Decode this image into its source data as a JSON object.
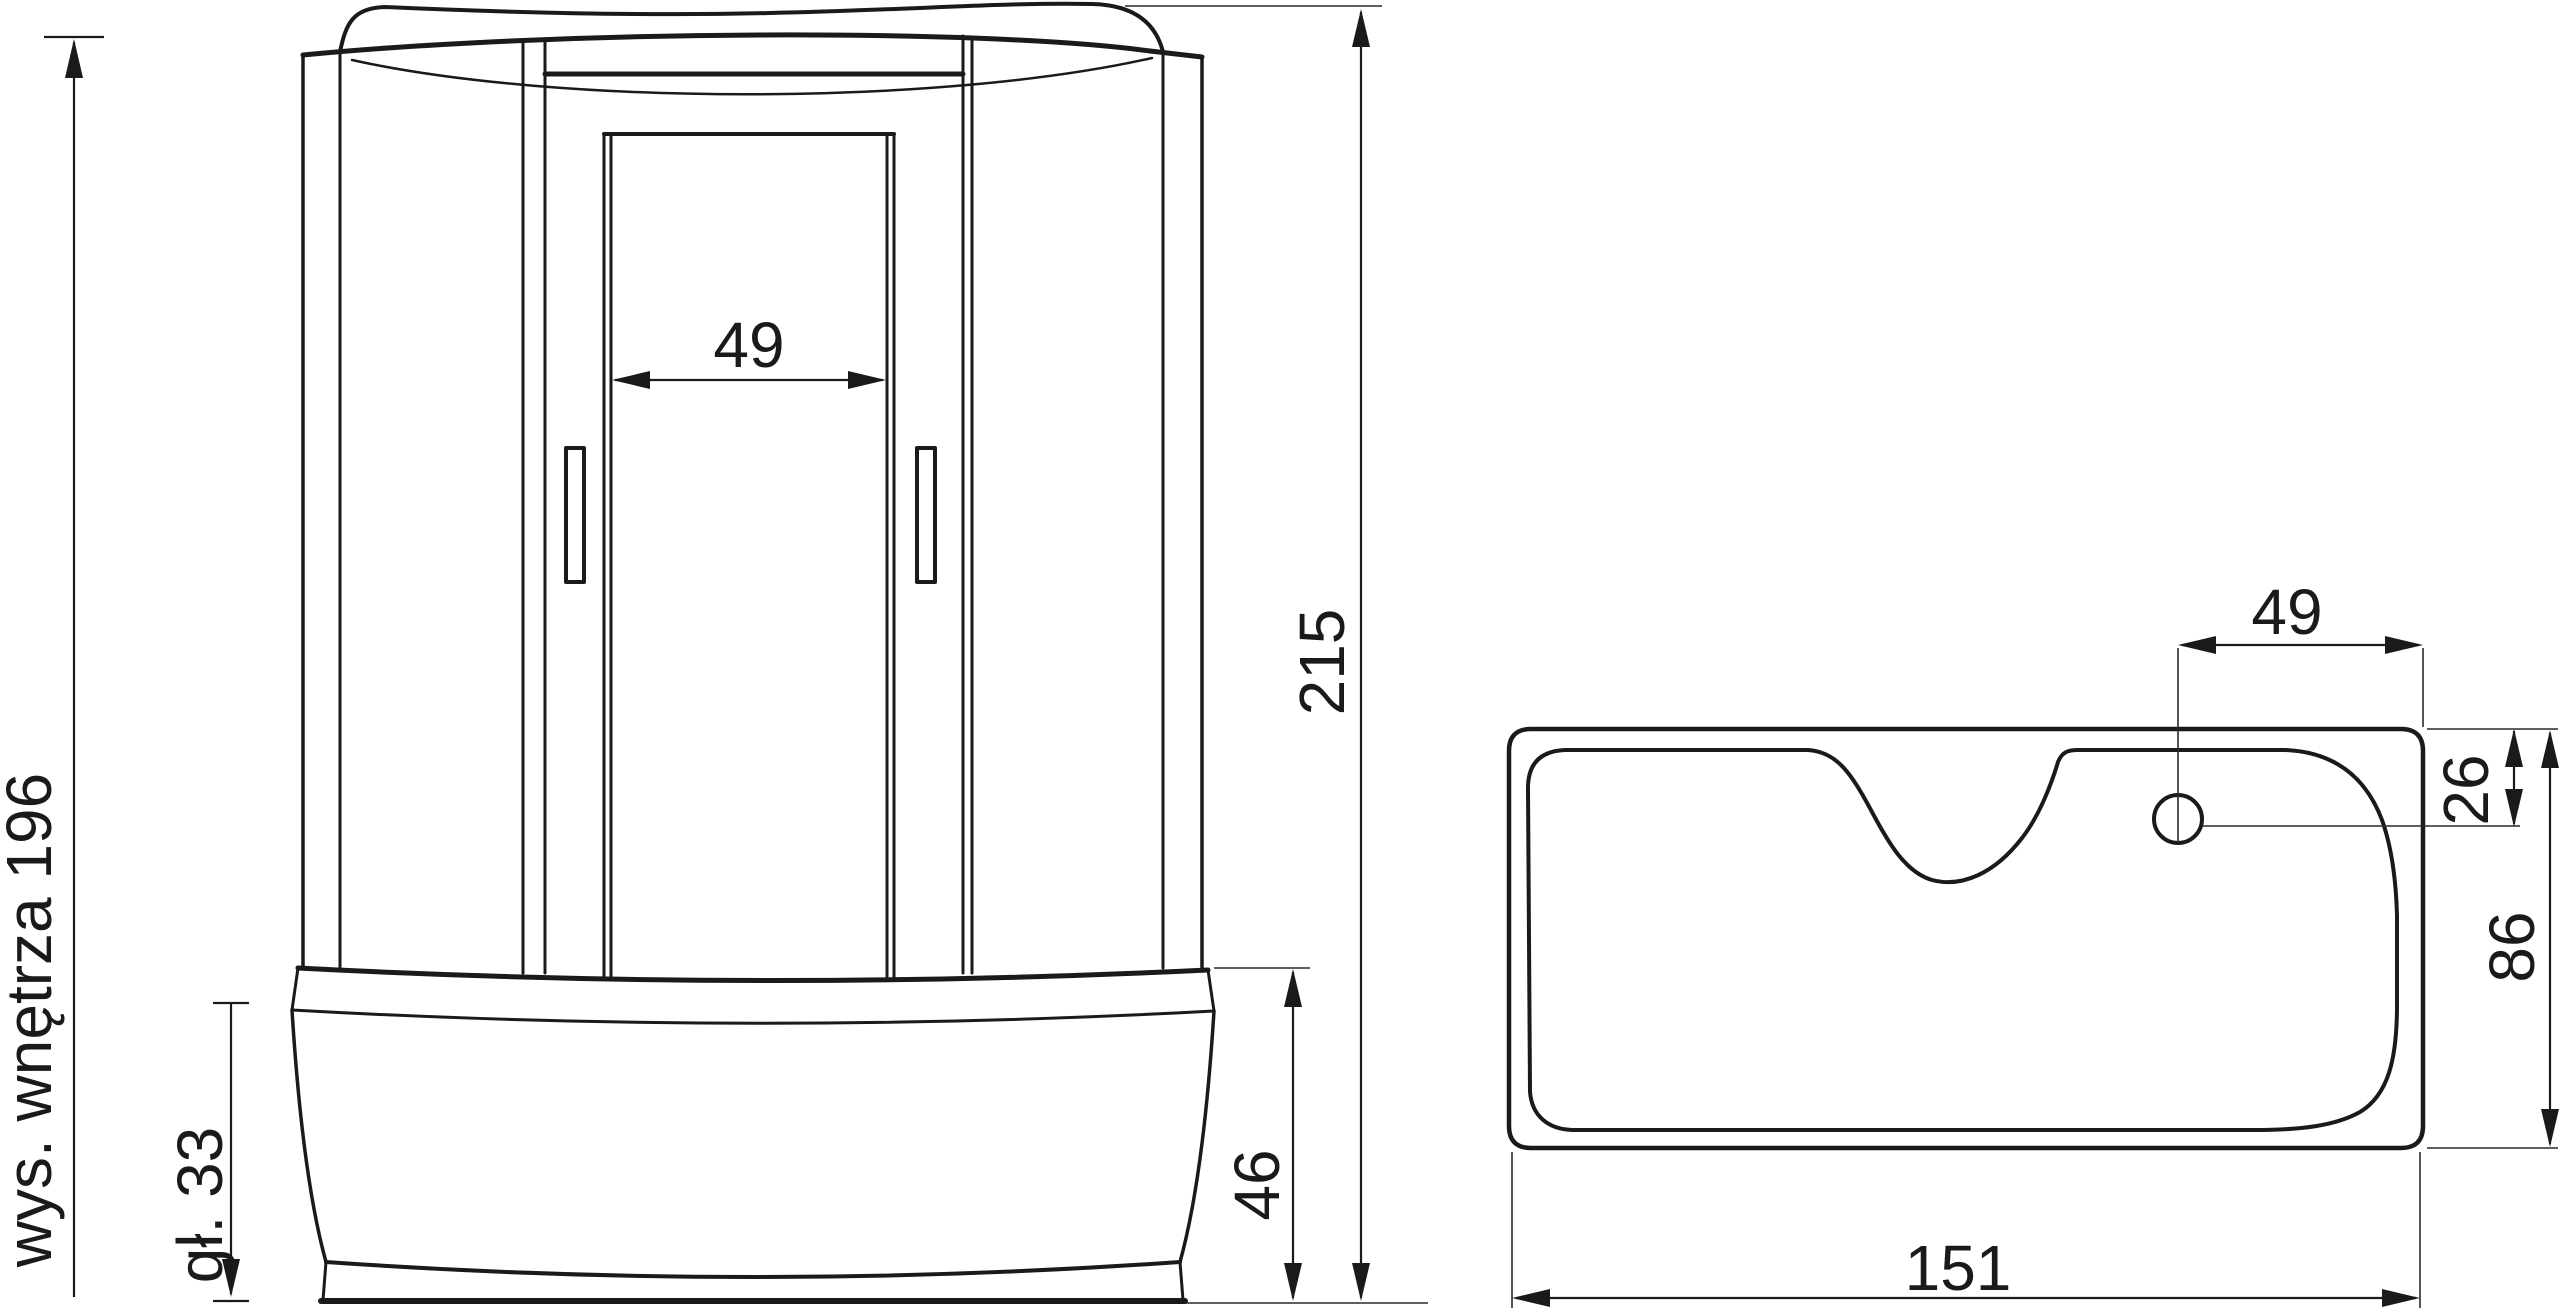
{
  "drawing": {
    "title": "shower-cabin-technical-drawing",
    "front_view": {
      "opening_width": "49",
      "interior_height": "wys. wnętrza 196",
      "basin_depth": "gł. 33",
      "basin_height": "46",
      "total_height": "215"
    },
    "top_view": {
      "opening_width": "49",
      "hole_edge_distance": "26",
      "depth": "86",
      "width": "151"
    },
    "colors": {
      "line": "#1a1a1a",
      "background": "#ffffff"
    }
  }
}
